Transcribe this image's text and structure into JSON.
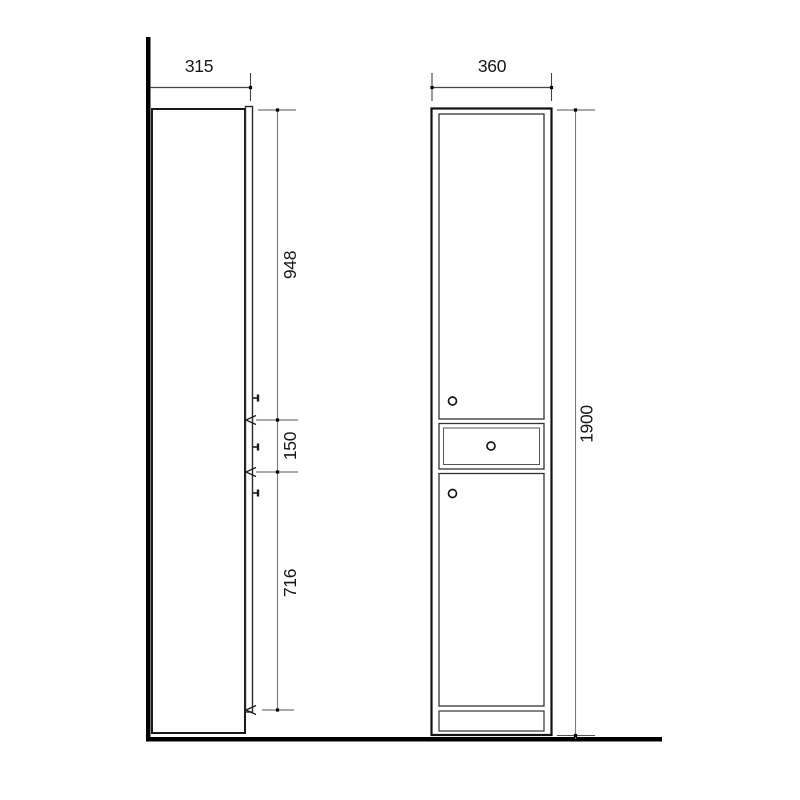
{
  "drawing": {
    "side_view": {
      "width_label": "315",
      "segment_top_label": "948",
      "segment_middle_label": "150",
      "segment_bottom_label": "716"
    },
    "front_view": {
      "width_label": "360",
      "height_label": "1900"
    },
    "colors": {
      "outline_dark": "#161616",
      "line_medium": "#3a3a3a",
      "dim_line_gray": "#7a7a7a",
      "background": "#ffffff"
    }
  }
}
